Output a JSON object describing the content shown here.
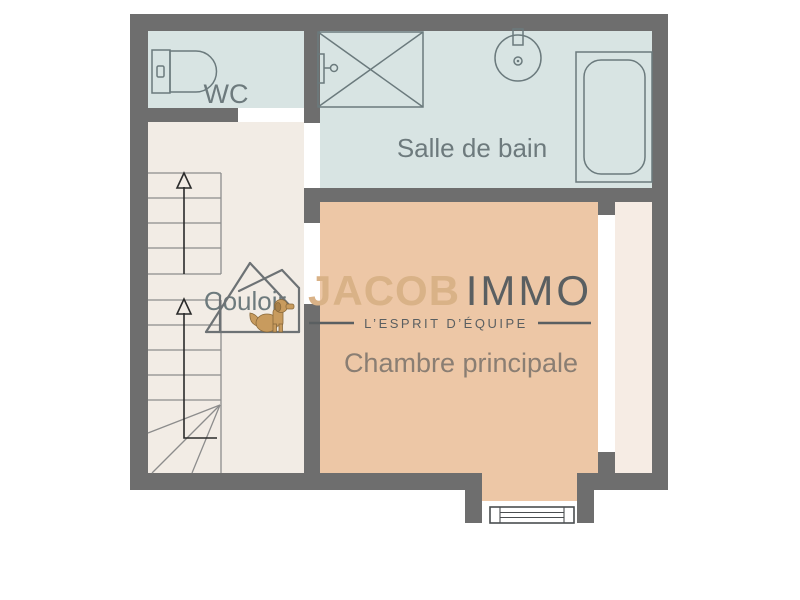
{
  "floor_plan": {
    "rooms": {
      "wc": {
        "label": "WC"
      },
      "bathroom": {
        "label": "Salle de bain"
      },
      "corridor": {
        "label": "Couloir"
      },
      "bedroom": {
        "label": "Chambre principale"
      }
    },
    "fixtures": {
      "toilet": "toilet-icon",
      "shower": "shower-icon",
      "sink": "sink-icon",
      "bathtub": "bathtub-icon",
      "window": "window-icon",
      "stairs": "staircase-icon"
    },
    "colors": {
      "wall": "#6e6e6e",
      "wet_room_fill": "#d8e4e3",
      "corridor_fill": "#f2ece5",
      "bedroom_fill": "#edc7a6",
      "closet_fill": "#f6ece4",
      "fixture_stroke": "#6b7a7d",
      "room_label_text": "#6d7a7d",
      "bedroom_label_text": "#8a7e73"
    }
  },
  "watermark": {
    "brand_primary": "JACOB",
    "brand_secondary": "IMMO",
    "tagline": "L’ESPRIT D’ÉQUIPE",
    "colors": {
      "brand_primary": "#d9b287",
      "brand_secondary": "#5a5f61",
      "house_outline": "#6d7275",
      "dog": "#c89b5e"
    },
    "icons": [
      "house-icon",
      "dog-icon"
    ]
  }
}
